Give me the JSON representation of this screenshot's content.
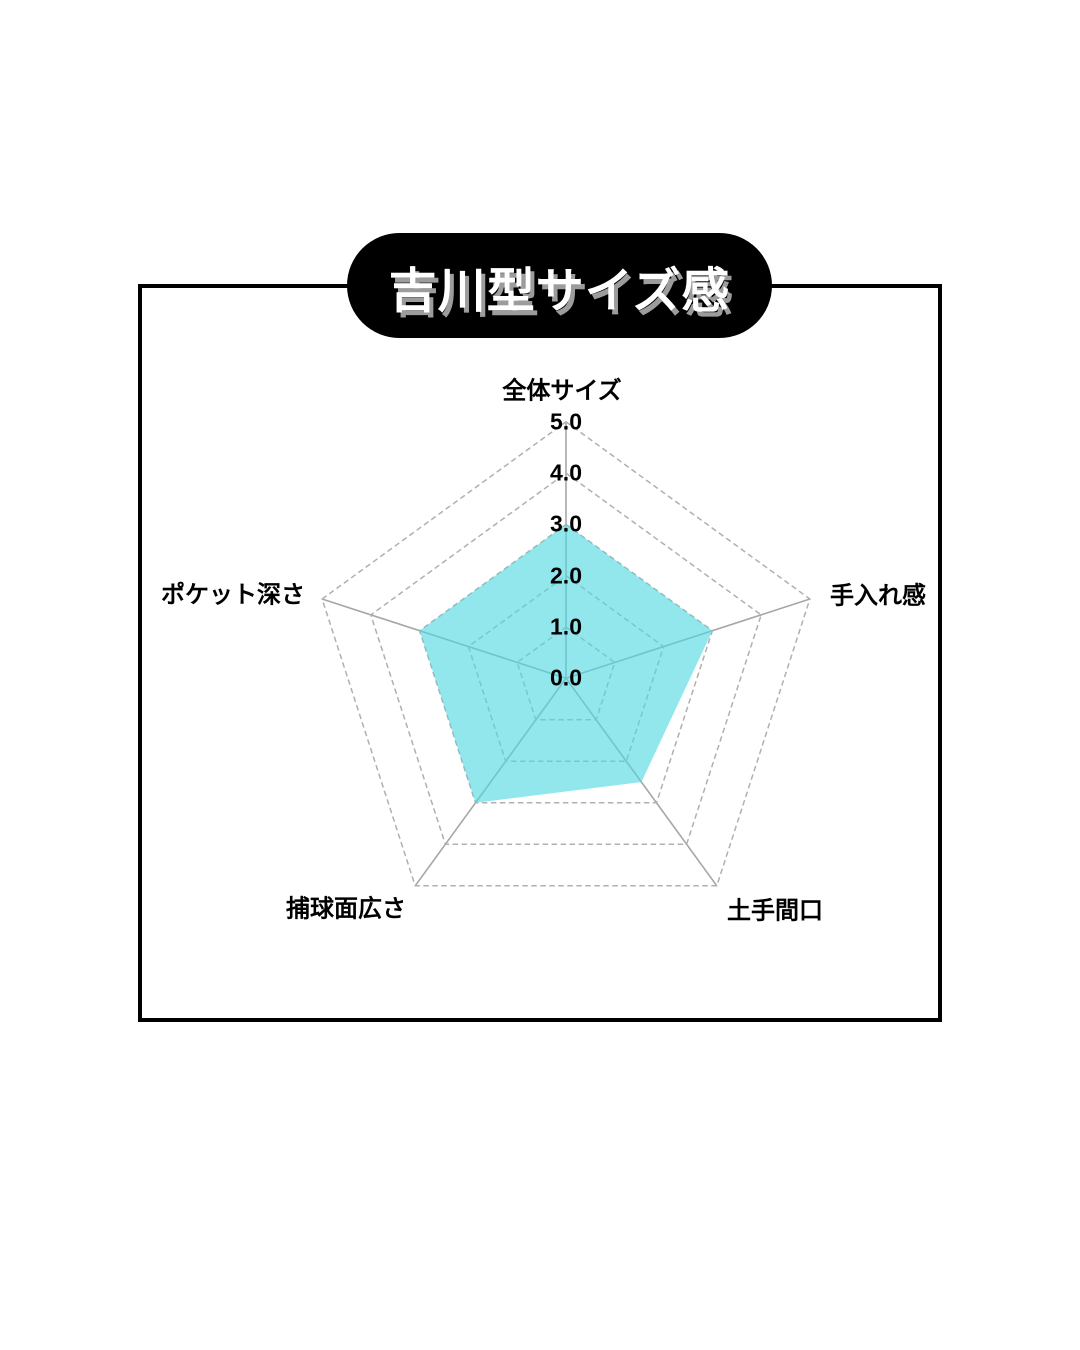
{
  "page": {
    "background": "#ffffff"
  },
  "title_pill": {
    "label": "吉川型サイズ感",
    "bg": "#000000",
    "text_color": "#ffffff",
    "shadow_color": "#9c9c9c"
  },
  "chart_data": {
    "type": "radar",
    "categories": [
      "全体サイズ",
      "手入れ感",
      "土手間口",
      "捕球面広さ",
      "ポケット深さ"
    ],
    "values": [
      3.0,
      3.0,
      2.5,
      3.0,
      3.0
    ],
    "r_min": 0,
    "r_max": 5,
    "tick_step": 1.0,
    "tick_labels": [
      "0.0",
      "1.0",
      "2.0",
      "3.0",
      "4.0",
      "5.0"
    ],
    "fill_color": "#4DD8E1",
    "fill_opacity": 0.62,
    "ring_color": "#B0B0B0",
    "spoke_color": "#A6A6A6",
    "ring_style": "dashed",
    "spoke_style": "solid",
    "legend": "none",
    "grid": "on"
  }
}
